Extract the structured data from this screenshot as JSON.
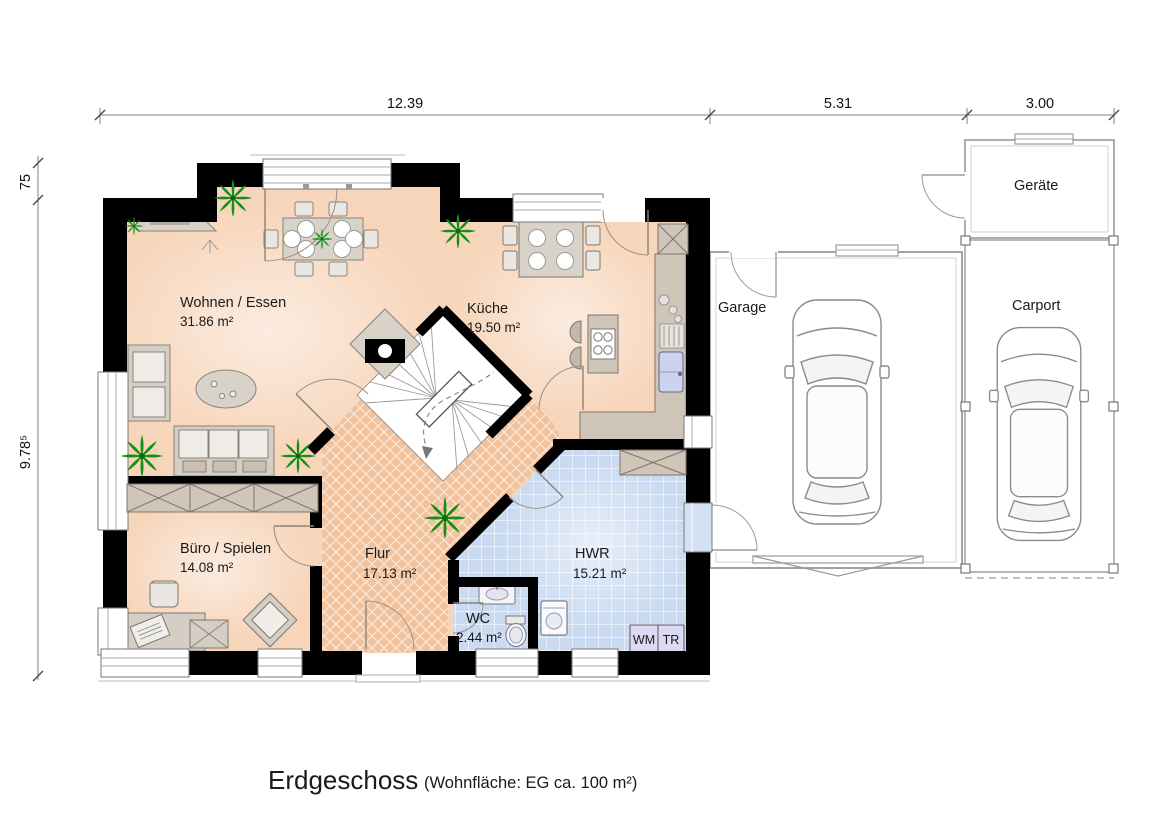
{
  "page": {
    "title": "Erdgeschoss",
    "subtitle": "(Wohnfläche: EG  ca. 100 m²)"
  },
  "dimensions": {
    "top": [
      "12.39",
      "5.31",
      "3.00"
    ],
    "left": [
      "75",
      "9.78⁵"
    ]
  },
  "rooms": {
    "wohnen": {
      "name": "Wohnen / Essen",
      "area": "31.86 m²"
    },
    "kueche": {
      "name": "Küche",
      "area": "19.50 m²"
    },
    "buero": {
      "name": "Büro / Spielen",
      "area": "14.08 m²"
    },
    "flur": {
      "name": "Flur",
      "area": "17.13 m²"
    },
    "hwr": {
      "name": "HWR",
      "area": "15.21 m²"
    },
    "wc": {
      "name": "WC",
      "area": "2.44 m²"
    },
    "garage": {
      "name": "Garage"
    },
    "carport": {
      "name": "Carport"
    },
    "geraete": {
      "name": "Geräte"
    }
  },
  "appliances": {
    "washer": "WM",
    "dryer": "TR"
  },
  "colors": {
    "living_floor": "#f7d5ba",
    "hall_floor": "#f2c29c",
    "utility_floor": "#c9daf1",
    "wall": "#000000",
    "furniture": "#cfc5b9",
    "plant": "#159015",
    "outbuilding_line": "#999999"
  }
}
